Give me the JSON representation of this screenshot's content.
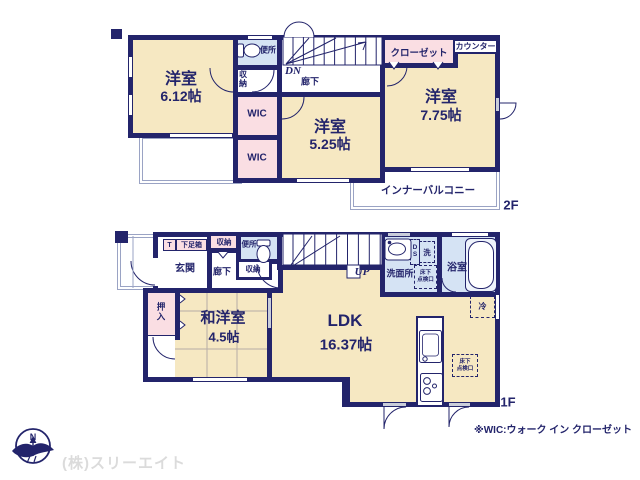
{
  "colors": {
    "wall": "#23246b",
    "room_tan": "#f6e8c2",
    "closet_pink": "#fadee3",
    "wet_blue": "#d5e3f4",
    "balcony_line": "#9aa3c4",
    "opening_gray": "#c9cdda",
    "text_navy": "#23246b",
    "watermark_gray": "#dbdbdb"
  },
  "f2": {
    "floor_tag": "2F",
    "room1_name": "洋室",
    "room1_size": "6.12帖",
    "room2_name": "洋室",
    "room2_size": "5.25帖",
    "room3_name": "洋室",
    "room3_size": "7.75帖",
    "wic1": "WIC",
    "wic2": "WIC",
    "closet": "クローゼット",
    "counter": "カウンター",
    "toilet": "便所",
    "storage": "収納",
    "dn": "DN",
    "hall": "廊下",
    "balcony": "インナーバルコニー"
  },
  "f1": {
    "floor_tag": "1F",
    "genkan": "玄関",
    "t": "T",
    "shoebox": "下足箱",
    "storage_top": "収納",
    "toilet": "便所",
    "storage_mid": "収納",
    "hall": "廊下",
    "up": "UP",
    "washroom": "洗面所",
    "ds": "DS",
    "washer": "洗",
    "bath": "浴室",
    "oshiire": "押入",
    "washitsu_name": "和洋室",
    "washitsu_size": "4.5帖",
    "ldk_name": "LDK",
    "ldk_size": "16.37帖",
    "fridge": "冷",
    "hatch_line1": "床下",
    "hatch_line2": "点検口"
  },
  "footer": {
    "note": "※WIC:ウォーク イン クローゼット",
    "company": "(株)スリーエイト",
    "compass_n": "N"
  }
}
